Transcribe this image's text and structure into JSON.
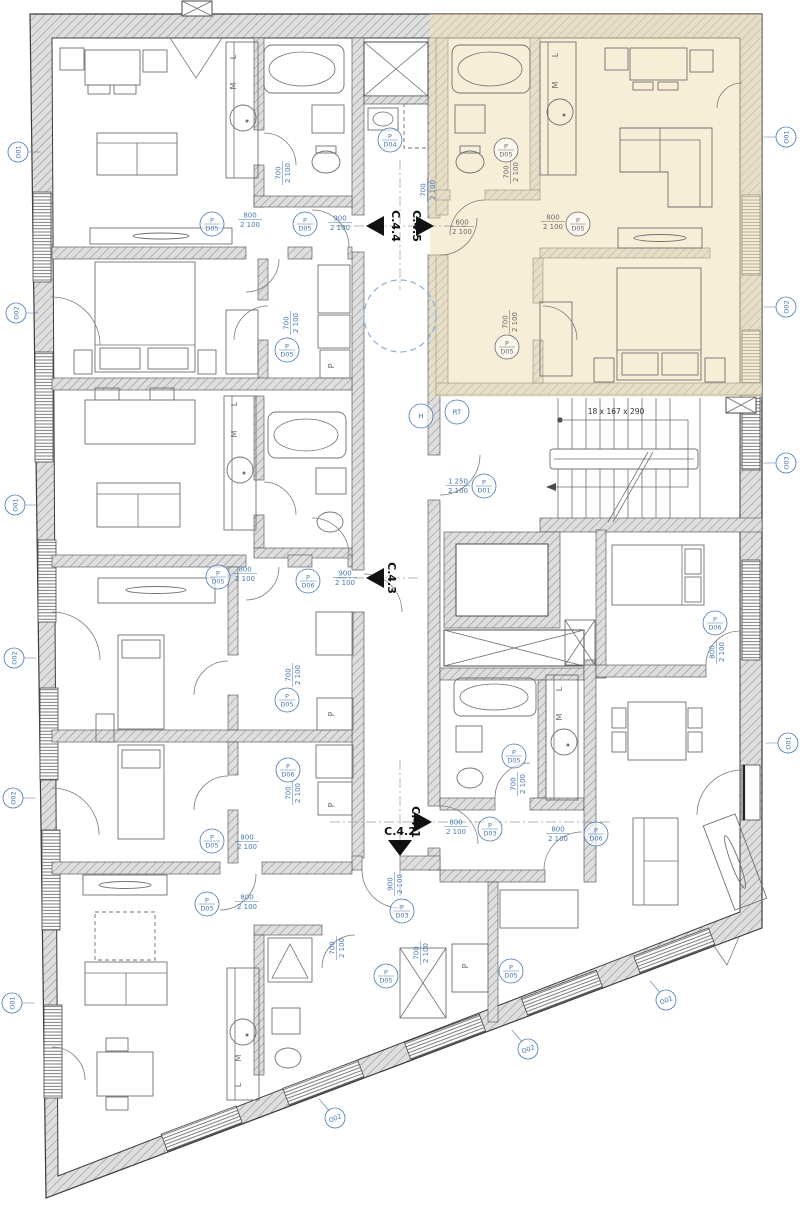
{
  "drawing_name": "residential-floor-plan",
  "colors": {
    "highlight": "#f2e6c9",
    "annotation_blue": "#4878b0",
    "annotation_gray": "#6b6b6b",
    "hatch_gray": "#8f8f8f",
    "line": "#4a4a4a",
    "dashed_circle_blue": "#8ab0dd"
  },
  "stair_note": {
    "text": "18 x 167 x 290",
    "x": 616,
    "y": 414
  },
  "sections": [
    {
      "label": "C.4.5",
      "x": 413,
      "y": 226,
      "rot": 90
    },
    {
      "label": "C.4.4",
      "x": 392,
      "y": 226,
      "rot": 90
    },
    {
      "label": "C.4.3",
      "x": 388,
      "y": 578,
      "rot": 90
    },
    {
      "label": "C.4.1",
      "x": 412,
      "y": 822,
      "rot": 90
    },
    {
      "label": "C.4.2",
      "x": 400,
      "y": 835,
      "rot": 0
    }
  ],
  "dimensions": [
    {
      "x": 250,
      "y": 219,
      "rot": 0,
      "top": "800",
      "bottom": "2 100",
      "c": "b"
    },
    {
      "x": 340,
      "y": 222,
      "rot": 0,
      "top": "900",
      "bottom": "2 100",
      "c": "b"
    },
    {
      "x": 462,
      "y": 226,
      "rot": 0,
      "top": "600",
      "bottom": "2 100",
      "c": "g"
    },
    {
      "x": 553,
      "y": 221,
      "rot": 0,
      "top": "800",
      "bottom": "2 100",
      "c": "g"
    },
    {
      "x": 509,
      "y": 322,
      "rot": 90,
      "top": "700",
      "bottom": "2 100",
      "c": "g"
    },
    {
      "x": 510,
      "y": 172,
      "rot": 90,
      "top": "700",
      "bottom": "2 100",
      "c": "g"
    },
    {
      "x": 282,
      "y": 173,
      "rot": 90,
      "top": "700",
      "bottom": "2 100",
      "c": "b"
    },
    {
      "x": 290,
      "y": 323,
      "rot": 90,
      "top": "700",
      "bottom": "2 100",
      "c": "b"
    },
    {
      "x": 427,
      "y": 190,
      "rot": 90,
      "top": "700",
      "bottom": "2 100",
      "c": "b"
    },
    {
      "x": 245,
      "y": 573,
      "rot": 0,
      "top": "800",
      "bottom": "2 100",
      "c": "b"
    },
    {
      "x": 345,
      "y": 577,
      "rot": 0,
      "top": "900",
      "bottom": "2 100",
      "c": "b"
    },
    {
      "x": 292,
      "y": 675,
      "rot": 90,
      "top": "700",
      "bottom": "2 100",
      "c": "b"
    },
    {
      "x": 292,
      "y": 793,
      "rot": 90,
      "top": "700",
      "bottom": "2 100",
      "c": "b"
    },
    {
      "x": 247,
      "y": 841,
      "rot": 0,
      "top": "800",
      "bottom": "2 100",
      "c": "b"
    },
    {
      "x": 247,
      "y": 901,
      "rot": 0,
      "top": "800",
      "bottom": "2 100",
      "c": "b"
    },
    {
      "x": 336,
      "y": 948,
      "rot": 90,
      "top": "700",
      "bottom": "2 100",
      "c": "b"
    },
    {
      "x": 394,
      "y": 884,
      "rot": 90,
      "top": "900",
      "bottom": "2 100",
      "c": "b"
    },
    {
      "x": 456,
      "y": 826,
      "rot": 0,
      "top": "800",
      "bottom": "2 100",
      "c": "b"
    },
    {
      "x": 558,
      "y": 833,
      "rot": 0,
      "top": "800",
      "bottom": "2 100",
      "c": "b"
    },
    {
      "x": 517,
      "y": 784,
      "rot": 90,
      "top": "700",
      "bottom": "2 100",
      "c": "b"
    },
    {
      "x": 458,
      "y": 485,
      "rot": 0,
      "top": "1 250",
      "bottom": "2 100",
      "c": "b"
    },
    {
      "x": 716,
      "y": 652,
      "rot": 90,
      "top": "800",
      "bottom": "2 100",
      "c": "b"
    },
    {
      "x": 420,
      "y": 953,
      "rot": 90,
      "top": "700",
      "bottom": "2 100",
      "c": "b"
    }
  ],
  "door_tags": [
    {
      "x": 305,
      "y": 224,
      "top": "P",
      "bottom": "D05",
      "c": "b"
    },
    {
      "x": 212,
      "y": 224,
      "top": "P",
      "bottom": "D05",
      "c": "b"
    },
    {
      "x": 287,
      "y": 350,
      "top": "P",
      "bottom": "D05",
      "c": "b"
    },
    {
      "x": 390,
      "y": 140,
      "top": "P",
      "bottom": "D04",
      "c": "b"
    },
    {
      "x": 506,
      "y": 150,
      "top": "P",
      "bottom": "D05",
      "c": "g"
    },
    {
      "x": 507,
      "y": 347,
      "top": "P",
      "bottom": "D05",
      "c": "g"
    },
    {
      "x": 578,
      "y": 224,
      "top": "P",
      "bottom": "D05",
      "c": "g"
    },
    {
      "x": 218,
      "y": 577,
      "top": "P",
      "bottom": "D05",
      "c": "b"
    },
    {
      "x": 308,
      "y": 581,
      "top": "P",
      "bottom": "D06",
      "c": "b"
    },
    {
      "x": 287,
      "y": 700,
      "top": "P",
      "bottom": "D05",
      "c": "b"
    },
    {
      "x": 288,
      "y": 770,
      "top": "P",
      "bottom": "D06",
      "c": "b"
    },
    {
      "x": 212,
      "y": 841,
      "top": "P",
      "bottom": "D05",
      "c": "b"
    },
    {
      "x": 207,
      "y": 904,
      "top": "P",
      "bottom": "D05",
      "c": "b"
    },
    {
      "x": 402,
      "y": 911,
      "top": "P",
      "bottom": "D03",
      "c": "b"
    },
    {
      "x": 490,
      "y": 829,
      "top": "P",
      "bottom": "D03",
      "c": "b"
    },
    {
      "x": 596,
      "y": 834,
      "top": "P",
      "bottom": "D06",
      "c": "b"
    },
    {
      "x": 514,
      "y": 756,
      "top": "P",
      "bottom": "D05",
      "c": "b"
    },
    {
      "x": 484,
      "y": 486,
      "top": "P",
      "bottom": "D01",
      "c": "b"
    },
    {
      "x": 715,
      "y": 623,
      "top": "P",
      "bottom": "D06",
      "c": "b"
    },
    {
      "x": 386,
      "y": 976,
      "top": "P",
      "bottom": "D05",
      "c": "b"
    },
    {
      "x": 511,
      "y": 971,
      "top": "P",
      "bottom": "D05",
      "c": "b"
    },
    {
      "x": 421,
      "y": 416,
      "top": "H",
      "bottom": "",
      "c": "b"
    },
    {
      "x": 457,
      "y": 412,
      "top": "RT",
      "bottom": "",
      "c": "b"
    }
  ],
  "window_tags": [
    {
      "x": 18,
      "y": 152,
      "rot": -90,
      "label": "O01",
      "ldx": 14,
      "ldy": 0
    },
    {
      "x": 16,
      "y": 313,
      "rot": -90,
      "label": "O02",
      "ldx": 14,
      "ldy": 0
    },
    {
      "x": 15,
      "y": 505,
      "rot": -90,
      "label": "O01",
      "ldx": 14,
      "ldy": 0
    },
    {
      "x": 14,
      "y": 658,
      "rot": -90,
      "label": "O02",
      "ldx": 14,
      "ldy": 0
    },
    {
      "x": 13,
      "y": 798,
      "rot": -90,
      "label": "O02",
      "ldx": 14,
      "ldy": 0
    },
    {
      "x": 12,
      "y": 1003,
      "rot": -90,
      "label": "O01",
      "ldx": 14,
      "ldy": 0
    },
    {
      "x": 786,
      "y": 137,
      "rot": -90,
      "label": "O01",
      "ldx": -14,
      "ldy": 0
    },
    {
      "x": 786,
      "y": 307,
      "rot": -90,
      "label": "O02",
      "ldx": -14,
      "ldy": 0
    },
    {
      "x": 786,
      "y": 463,
      "rot": -90,
      "label": "O03",
      "ldx": -14,
      "ldy": 0
    },
    {
      "x": 788,
      "y": 743,
      "rot": -90,
      "label": "O01",
      "ldx": -14,
      "ldy": 0
    },
    {
      "x": 666,
      "y": 1000,
      "rot": -21,
      "label": "O01",
      "ldx": -10,
      "ldy": -12
    },
    {
      "x": 528,
      "y": 1049,
      "rot": -21,
      "label": "O02",
      "ldx": -10,
      "ldy": -12
    },
    {
      "x": 335,
      "y": 1118,
      "rot": -21,
      "label": "O02",
      "ldx": -10,
      "ldy": -12
    }
  ],
  "room_letters": [
    {
      "x": 334,
      "y": 366,
      "rot": 90,
      "t": "P"
    },
    {
      "x": 334,
      "y": 714,
      "rot": 90,
      "t": "P"
    },
    {
      "x": 334,
      "y": 805,
      "rot": 90,
      "t": "P"
    },
    {
      "x": 468,
      "y": 966,
      "rot": 90,
      "t": "P"
    },
    {
      "x": 236,
      "y": 57,
      "rot": 90,
      "t": "L"
    },
    {
      "x": 236,
      "y": 86,
      "rot": 90,
      "t": "M"
    },
    {
      "x": 558,
      "y": 55,
      "rot": 90,
      "t": "L"
    },
    {
      "x": 558,
      "y": 85,
      "rot": 90,
      "t": "M"
    },
    {
      "x": 237,
      "y": 404,
      "rot": 90,
      "t": "L"
    },
    {
      "x": 237,
      "y": 434,
      "rot": 90,
      "t": "M"
    },
    {
      "x": 241,
      "y": 1058,
      "rot": 90,
      "t": "M"
    },
    {
      "x": 241,
      "y": 1085,
      "rot": 90,
      "t": "L"
    },
    {
      "x": 562,
      "y": 689,
      "rot": 90,
      "t": "L"
    },
    {
      "x": 562,
      "y": 717,
      "rot": 90,
      "t": "M"
    }
  ]
}
